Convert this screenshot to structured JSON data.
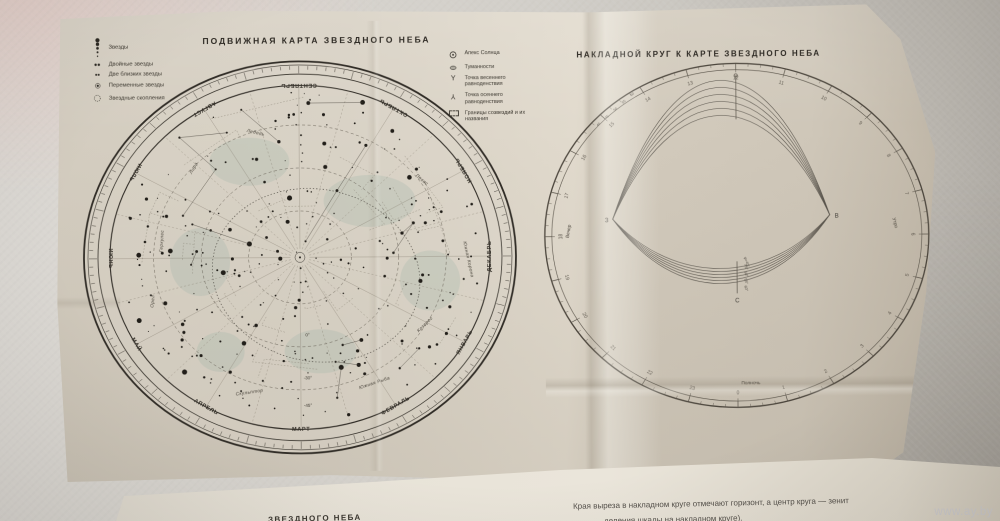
{
  "photo": {
    "watermark": "www.ay.by"
  },
  "left_chart": {
    "title": "ПОДВИЖНАЯ КАРТА ЗВЕЗДНОГО НЕБА",
    "legend": [
      {
        "symbol": "star-sizes",
        "label": "Звезды"
      },
      {
        "symbol": "double-star",
        "label": "Двойные звезды"
      },
      {
        "symbol": "two-close-stars",
        "label": "Две близких звезды"
      },
      {
        "symbol": "variable-star",
        "label": "Переменные звезды"
      },
      {
        "symbol": "star-cluster",
        "label": "Звездные скопления"
      }
    ],
    "months": [
      "СЕНТЯБРЬ",
      "ОКТЯБРЬ",
      "НОЯБРЬ",
      "ДЕКАБРЬ",
      "ЯНВАРЬ",
      "ФЕВРАЛЬ",
      "МАРТ",
      "АПРЕЛЬ",
      "МАЙ",
      "ИЮНЬ",
      "ИЮЛЬ",
      "АВГУСТ"
    ],
    "declination_labels": [
      {
        "text": "0°",
        "f": 0.45
      },
      {
        "text": "-30°",
        "f": 0.7
      },
      {
        "text": "-45°",
        "f": 0.86
      }
    ],
    "constellations": [
      {
        "name": "Скульптор",
        "x": -0.27,
        "y": 0.79,
        "rot": -8
      },
      {
        "name": "Южная Рыба",
        "x": 0.39,
        "y": 0.74,
        "rot": -18
      },
      {
        "name": "Южная Корона",
        "x": 0.88,
        "y": 0.02,
        "rot": 78
      },
      {
        "name": "Козерог",
        "x": 0.66,
        "y": 0.4,
        "rot": -45
      },
      {
        "name": "Лира",
        "x": -0.55,
        "y": -0.52,
        "rot": -60
      },
      {
        "name": "Лебедь",
        "x": -0.23,
        "y": -0.72,
        "rot": 14
      },
      {
        "name": "Орел",
        "x": -0.77,
        "y": 0.25,
        "rot": -84
      },
      {
        "name": "Пегас",
        "x": 0.64,
        "y": -0.44,
        "rot": 40
      },
      {
        "name": "Геркулес",
        "x": -0.72,
        "y": -0.1,
        "rot": -86
      }
    ]
  },
  "right_chart": {
    "title": "НАКЛАДНОЙ КРУГ К КАРТЕ ЗВЕЗДНОГО НЕБА",
    "legend": [
      {
        "symbol": "sun-apex",
        "label": "Апекс Солнца"
      },
      {
        "symbol": "nebula",
        "label": "Туманности"
      },
      {
        "symbol": "vernal-equinox",
        "label": "Точка весеннего равноденствия"
      },
      {
        "symbol": "autumnal-equinox",
        "label": "Точка осеннего равноденствия"
      },
      {
        "symbol": "constellation-borders",
        "label": "Границы созвездий и их названия"
      }
    ],
    "hours": [
      "0",
      "1",
      "2",
      "3",
      "4",
      "5",
      "6",
      "7",
      "8",
      "9",
      "10",
      "11",
      "12",
      "13",
      "14",
      "15",
      "16",
      "17",
      "18",
      "19",
      "20",
      "21",
      "22",
      "23"
    ],
    "compass": {
      "west": "З",
      "east": "В",
      "north": "С"
    },
    "time_labels": {
      "evening": "Вечер",
      "morning": "Утро",
      "midnight": "Полночь"
    },
    "latitude_labels": [
      "φ=40°",
      "45°",
      "50°",
      "55°",
      "60°"
    ],
    "fan_labels": [
      "40",
      "45",
      "50",
      "55",
      "60"
    ]
  },
  "caption": {
    "line1": "Края выреза в накладном круге отмечают горизонт, а центр круга — зенит",
    "line2": "деления шкалы на накладном круге).",
    "partial_title": "ЗВЕЗДНОГО НЕБА"
  }
}
